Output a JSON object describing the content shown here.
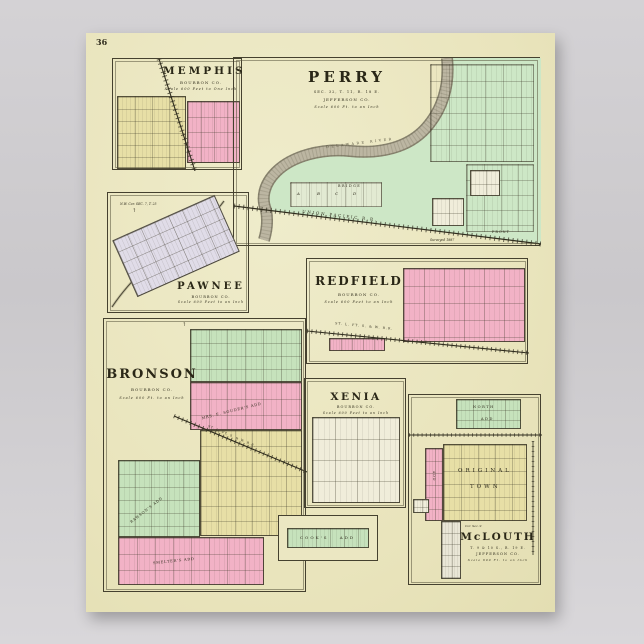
{
  "page_number": "36",
  "palette": {
    "background": "#cdcbce",
    "paper": "#ebe7c2",
    "frame_ink": "#45412f",
    "block_yellow": "#e7dfa6",
    "block_pink": "#f2b2c6",
    "block_green": "#c6e2bc",
    "block_lavender": "#e0dce8",
    "block_white": "#f0edda",
    "field_green": "#cde7c6",
    "river_gray": "#b9b3a0",
    "text_ink": "#33301f"
  },
  "maps": {
    "memphis": {
      "title": "MEMPHIS",
      "county": "BOURBON CO.",
      "scale": "Scale 600 Feet to One Inch"
    },
    "perry": {
      "title": "PERRY",
      "section": "SEC. 32, T. 11, R. 18 E.",
      "county": "JEFFERSON CO.",
      "scale": "Scale 600 Ft. to an Inch",
      "railroad": "UNION PACIFIC R.R.",
      "river": "DELAWARE RIVER",
      "bridge_label": "BRIDGE",
      "front_label": "FRONT",
      "note": "Surveyed 1887",
      "block_letters": [
        "A",
        "B",
        "C",
        "D"
      ]
    },
    "pawnee": {
      "corner_note": "N.W. Cor. SEC. 7, T. 25",
      "title": "PAWNEE",
      "county": "BOURBON CO.",
      "scale": "Scale 600 Feet to an Inch"
    },
    "redfield": {
      "title": "REDFIELD",
      "county": "BOURBON CO.",
      "scale": "Scale 600 Feet to an Inch",
      "railroad": "ST. L. FT. S. & W. R.R."
    },
    "bronson": {
      "title": "BRONSON",
      "county": "BOURBON CO.",
      "scale": "Scale 600 Ft. to an Inch",
      "railroad": "ST. L. FT. S. & W. R.R.",
      "add_mid": "MRS. E. SOUDER'S ADD",
      "add_lower": "RAWSON'S ADD",
      "add_bottom": "SMELTER'S ADD",
      "add_cooks": "COOK'S ADD"
    },
    "xenia": {
      "title": "XENIA",
      "county": "BOURBON CO.",
      "scale": "Scale 600 Feet to an Inch"
    },
    "mclouth": {
      "title": "McLOUTH",
      "township": "T. 9 & 10 S., R. 19 E.",
      "county": "JEFFERSON CO.",
      "scale": "Scale 600 Ft. to an Inch",
      "north_add_1": "NORTH",
      "north_add_2": "ADD",
      "original_town_1": "ORIGINAL",
      "original_town_2": "TOWN",
      "corner_note": "Cor. Sec. 9",
      "add_label": "ADD"
    }
  }
}
